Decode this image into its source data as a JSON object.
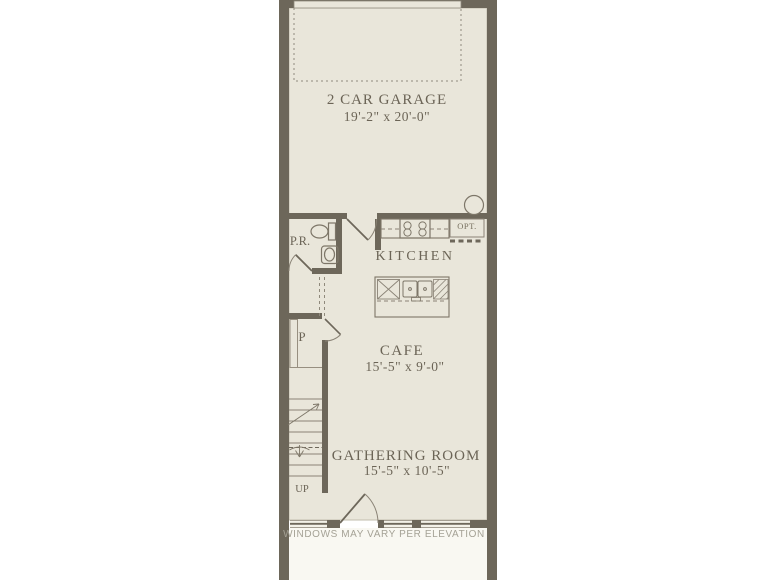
{
  "colors": {
    "wall": "#6d675a",
    "floor": "#e9e6da",
    "ink": "#6b6456",
    "note_text": "#a5a296",
    "outside": "#ffffff"
  },
  "rooms": {
    "garage": {
      "label": "2 CAR GARAGE",
      "dims": "19'-2\" x 20'-0\""
    },
    "kitchen": {
      "label": "KITCHEN"
    },
    "cafe": {
      "label": "CAFE",
      "dims": "15'-5\" x 9'-0\""
    },
    "gathering_room": {
      "label": "GATHERING ROOM",
      "dims": "15'-5\" x 10'-5\""
    },
    "powder_room": {
      "label": "P.R."
    },
    "pantry": {
      "label": "P"
    }
  },
  "annotations": {
    "stairs_direction": "UP",
    "optional_feature": "OPT.",
    "windows_note": "WINDOWS MAY VARY PER ELEVATION"
  }
}
